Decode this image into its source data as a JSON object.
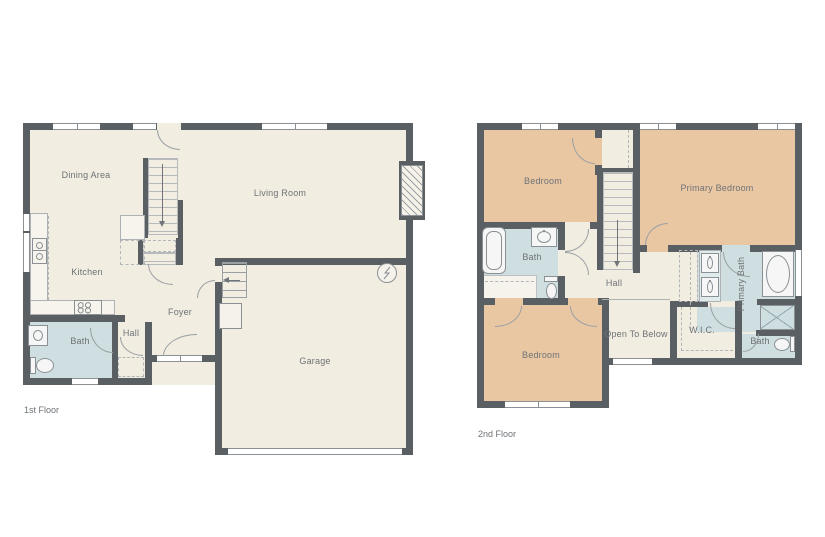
{
  "colors": {
    "background": "#ffffff",
    "wall": "#5a5f63",
    "floor": "#f2ede1",
    "bedroom_floor": "#eac7a3",
    "bath_floor": "#cfdfe1",
    "fixture_line": "#8a9094",
    "label_text": "#6d7276"
  },
  "floors": [
    {
      "caption": "1st Floor",
      "rooms": [
        {
          "label": "Dining Area"
        },
        {
          "label": "Living Room"
        },
        {
          "label": "Kitchen"
        },
        {
          "label": "Bath"
        },
        {
          "label": "Hall"
        },
        {
          "label": "Foyer"
        },
        {
          "label": "Garage"
        }
      ]
    },
    {
      "caption": "2nd Floor",
      "rooms": [
        {
          "label": "Bedroom"
        },
        {
          "label": "Primary Bedroom"
        },
        {
          "label": "Bath"
        },
        {
          "label": "Hall"
        },
        {
          "label": "Primary Bath"
        },
        {
          "label": "Open To Below"
        },
        {
          "label": "W.I.C."
        },
        {
          "label": "Bedroom"
        },
        {
          "label": "Bath"
        }
      ]
    }
  ]
}
